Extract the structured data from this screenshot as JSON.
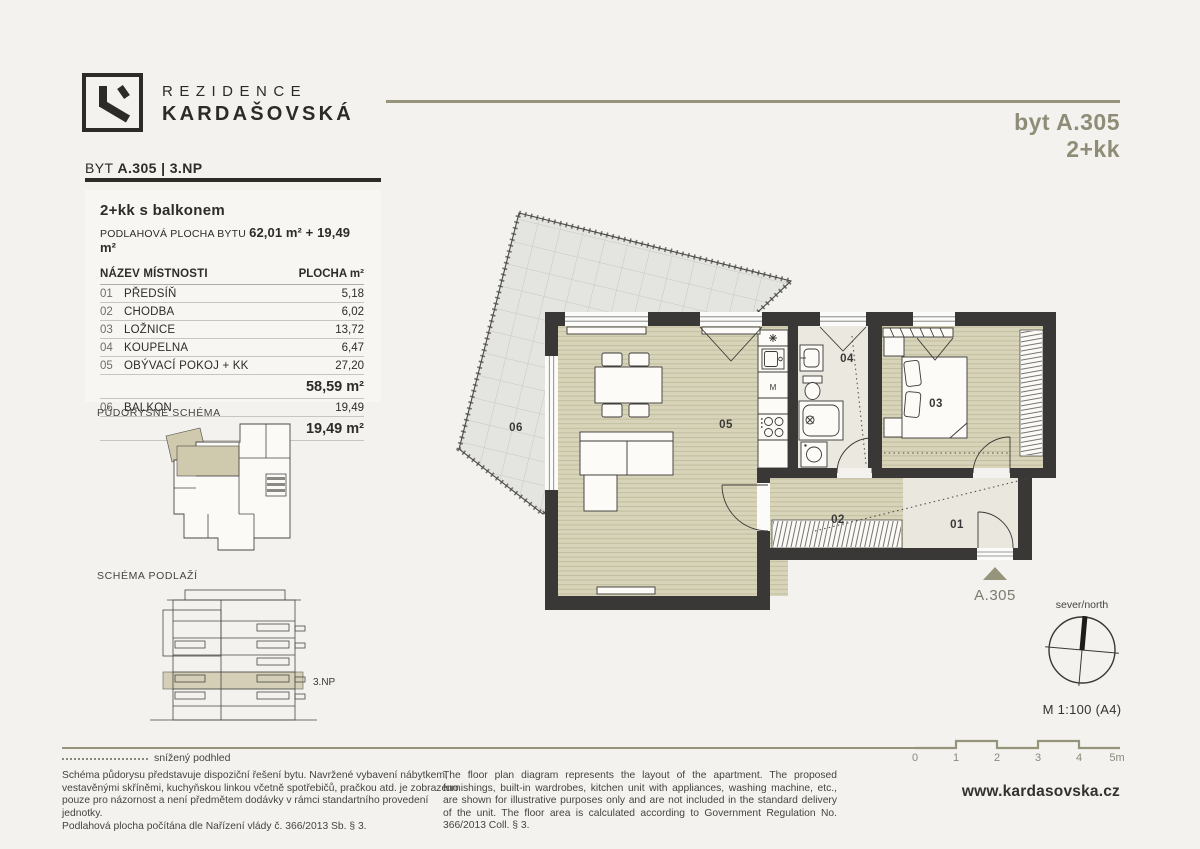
{
  "colors": {
    "accent": "#97947c",
    "accent-text": "#8f8d77",
    "ink": "#2d2c29",
    "wall": "#3a3836",
    "floor-wood": "#d8d4b9",
    "balcony": "#e4e4e1"
  },
  "brand": {
    "line1": "REZIDENCE",
    "line2": "KARDAŠOVSKÁ"
  },
  "header": {
    "prefix": "BYT",
    "unit": "A.305 | 3.NP"
  },
  "badge": {
    "line1": "byt A.305",
    "line2": "2+kk"
  },
  "table": {
    "title": "2+kk s balkonem",
    "subtitle_label": "PODLAHOVÁ PLOCHA BYTU",
    "subtitle_value": "62,01 m² + 19,49 m²",
    "col_name": "NÁZEV MÍSTNOSTI",
    "col_area": "PLOCHA m²",
    "rows": [
      {
        "num": "01",
        "name": "PŘEDSÍŇ",
        "area": "5,18"
      },
      {
        "num": "02",
        "name": "CHODBA",
        "area": "6,02"
      },
      {
        "num": "03",
        "name": "LOŽNICE",
        "area": "13,72"
      },
      {
        "num": "04",
        "name": "KOUPELNA",
        "area": "6,47"
      },
      {
        "num": "05",
        "name": "OBÝVACÍ POKOJ + KK",
        "area": "27,20"
      }
    ],
    "subtotal": "58,59 m²",
    "balcony_row": {
      "num": "06",
      "name": "BALKON",
      "area": "19,49"
    },
    "balcony_total": "19,49 m²"
  },
  "schematics": {
    "plan_label": "PŮDORYSNÉ SCHÉMA",
    "floor_label": "SCHÉMA PODLAŽÍ",
    "floor_tag": "3.NP"
  },
  "plan": {
    "rooms": {
      "r01": "01",
      "r02": "02",
      "r03": "03",
      "r04": "04",
      "r05": "05",
      "r06": "06"
    },
    "kitchen_m": "M",
    "marker": "A.305"
  },
  "compass": {
    "label": "sever/north",
    "scale": "M 1:100 (A4)"
  },
  "scalebar": {
    "ticks": [
      "0",
      "1",
      "2",
      "3",
      "4",
      "5m"
    ]
  },
  "legend": {
    "dotted_label": "snížený podhled"
  },
  "disclaimer": {
    "cs": "Schéma půdorysu představuje dispoziční řešení bytu. Navržené vybavení nábytkem, vestavěnými skříněmi, kuchyňskou linkou včetně spotřebičů, pračkou atd. je zobrazeno pouze pro názornost a není předmětem dodávky v rámci standartního provedení jednotky.",
    "cs2": "Podlahová plocha počítána dle Nařízení vlády č. 366/2013 Sb. § 3.",
    "en": "The floor plan diagram represents the layout of the apartment. The proposed furnishings, built-in wardrobes, kitchen unit with appliances, washing machine, etc., are shown for illustrative purposes only and are not included in the standard delivery of the unit. The floor area is calculated according to Government Regulation No. 366/2013 Coll. § 3."
  },
  "website": "www.kardasovska.cz"
}
